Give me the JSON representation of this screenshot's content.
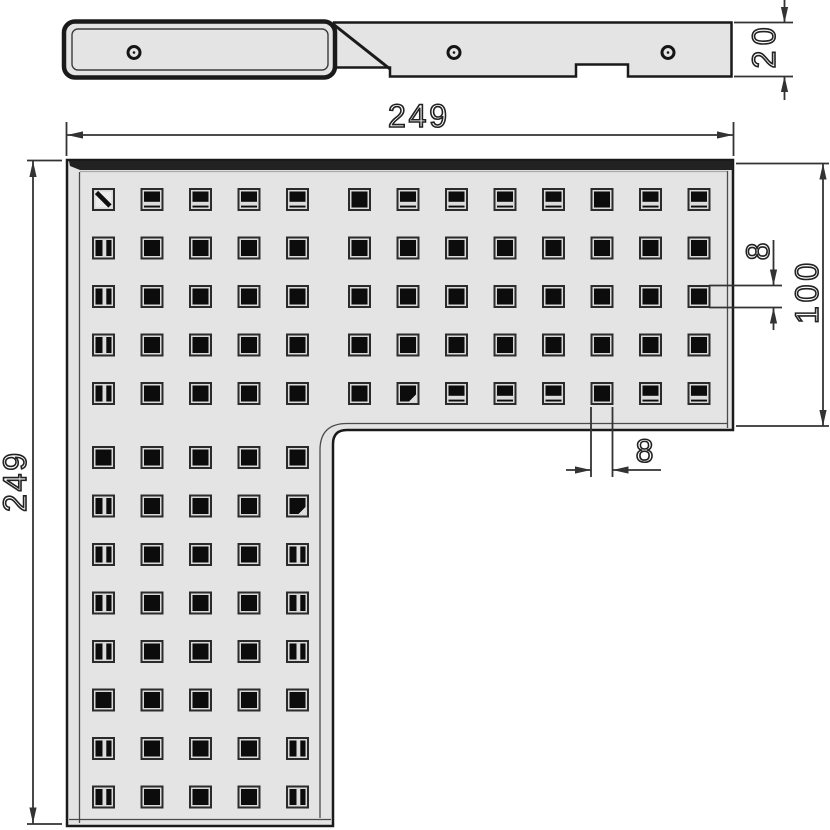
{
  "drawing": {
    "title": "L-shaped perforated corner grate - technical drawing",
    "views": {
      "profile": {
        "name": "side profile view",
        "round_hole_count": 3
      },
      "plan": {
        "name": "plan view of L-shaped grate"
      }
    },
    "dimensions": {
      "overall_width": "249",
      "overall_height": "249",
      "thickness": "20",
      "arm_width": "100",
      "hole_size_vertical": "8",
      "hole_size_horizontal": "8"
    },
    "grid": {
      "legend": {
        "P": "open-square-hole",
        "H": "hole-with-bottom-wall-visible",
        "V": "hole-with-side-wall-visible",
        "D": "hole-with-diagonal-mark",
        "C": "hole-with-cut-corner"
      },
      "rows": [
        "DHHHHPHHHHPHH",
        "VPPPPPPPPPPPP",
        "VPPPPPPPPPPPP",
        "VPPPPPPPPPPPP",
        "VPPPPPCHHHPHH",
        "PPPPP",
        "VPPPC",
        "VPPPV",
        "VPPPV",
        "VPPPV",
        "PPPPP",
        "VPPPV",
        "VPPPV"
      ]
    },
    "colors": {
      "plate_fill": "#e4e4e4",
      "outline": "#1a1a1a",
      "dim_line": "#333333",
      "hole_dark": "#0c0c0c",
      "top_edge_band": "#222222"
    }
  }
}
